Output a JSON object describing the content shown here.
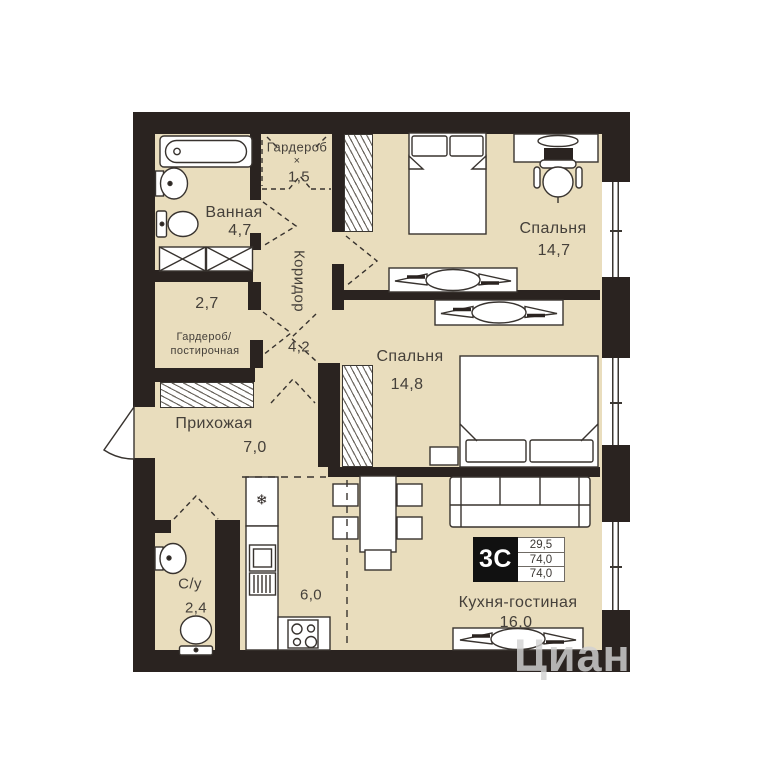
{
  "colors": {
    "floor": "#e9ddbd",
    "wall": "#2a2320",
    "text": "#45403a",
    "badge_bg": "#111111",
    "watermark": "#d2d2d2"
  },
  "rooms": {
    "wardrobe": {
      "name": "Гардероб",
      "times": "×",
      "area": "1,5"
    },
    "bathroom": {
      "name": "Ванная",
      "area": "4,7"
    },
    "bedroom_top": {
      "name": "Спальня",
      "area": "14,7"
    },
    "laundry": {
      "area": "2,7",
      "name_line1": "Гардероб/",
      "name_line2": "постирочная"
    },
    "corridor": {
      "name": "Коридор",
      "area": "4,2"
    },
    "bedroom_mid": {
      "name": "Спальня",
      "area": "14,8"
    },
    "hallway": {
      "name": "Прихожая",
      "area": "7,0"
    },
    "wc": {
      "name": "С/у",
      "area": "2,4"
    },
    "kitchen_zone": {
      "area": "6,0"
    },
    "kitchen_living": {
      "name": "Кухня-гостиная",
      "area": "16,0"
    }
  },
  "info_badge": {
    "apartment_type": "3С",
    "areas": [
      "29,5",
      "74,0",
      "74,0"
    ]
  },
  "icons": {
    "fridge_snowflake": "❄"
  },
  "watermark": "Циан"
}
